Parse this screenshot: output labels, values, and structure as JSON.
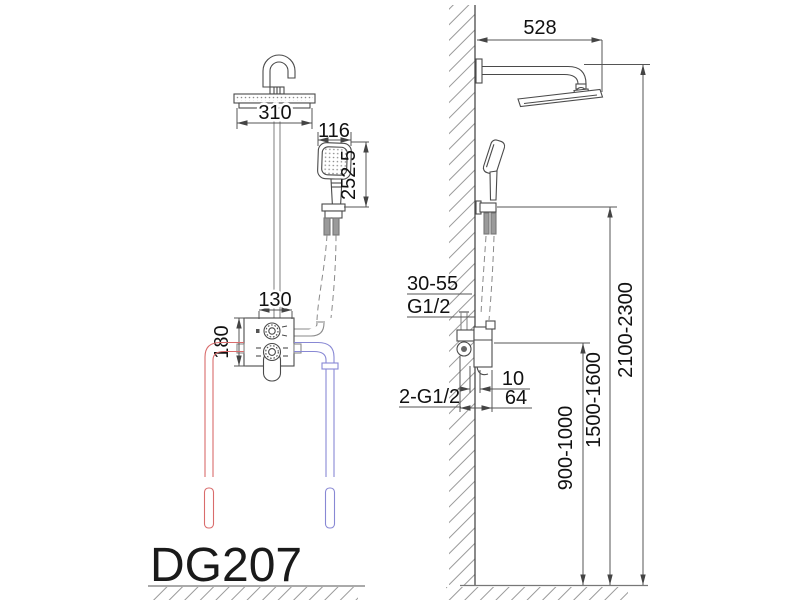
{
  "title": {
    "model_label": "DG207"
  },
  "front_view": {
    "head_width": "310",
    "hand_shower_width": "116",
    "hand_shower_length": "252.5",
    "valve_width": "130",
    "valve_height": "180"
  },
  "side_view": {
    "arm_reach": "528",
    "overall_height_range": "2100-2300",
    "holder_height_range": "1500-1600",
    "valve_height_range": "900-1000",
    "embed_depth_range": "30-55",
    "outlet_thread": "G1/2",
    "inlet_thread": "2-G1/2",
    "offset_small": "10",
    "offset_large": "64"
  },
  "colors": {
    "hot_pipe": "#d96c6c",
    "cold_pipe": "#8888d4",
    "line": "#4a4a4a",
    "grey_part": "#8a8a8a"
  }
}
